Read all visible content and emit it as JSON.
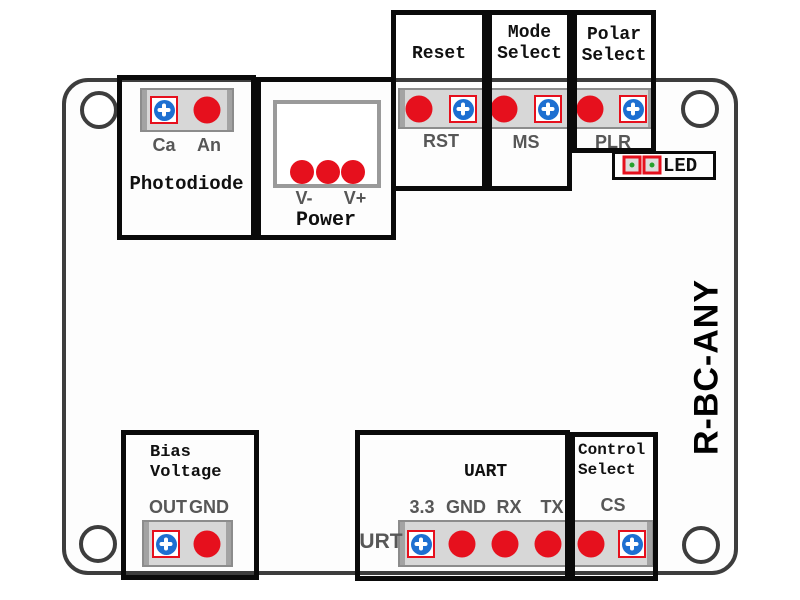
{
  "device": {
    "model_label": "R-BC-ANY"
  },
  "sections": {
    "photodiode": {
      "title": "Photodiode",
      "pin_cathode": "Ca",
      "pin_anode": "An"
    },
    "power": {
      "title": "Power",
      "v_minus": "V-",
      "v_plus": "V+"
    },
    "reset": {
      "title": "Reset",
      "pin": "RST"
    },
    "mode_select": {
      "title_line1": "Mode",
      "title_line2": "Select",
      "pin": "MS"
    },
    "polar_select": {
      "title_line1": "Polar",
      "title_line2": "Select",
      "pin": "PLR"
    },
    "led": {
      "label": "LED"
    },
    "bias_voltage": {
      "title_line1": "Bias",
      "title_line2": "Voltage",
      "pin_out": "OUT",
      "pin_gnd": "GND"
    },
    "uart": {
      "title": "UART",
      "side_label": "URT",
      "pin_33": "3.3",
      "pin_gnd": "GND",
      "pin_rx": "RX",
      "pin_tx": "TX"
    },
    "control_select": {
      "title_line1": "Control",
      "title_line2": "Select",
      "pin": "CS"
    }
  },
  "colors": {
    "pad_red": "#e6101d",
    "pad_blue": "#1d6fd1",
    "led_green": "#27a02c",
    "label_gray": "#575757"
  }
}
